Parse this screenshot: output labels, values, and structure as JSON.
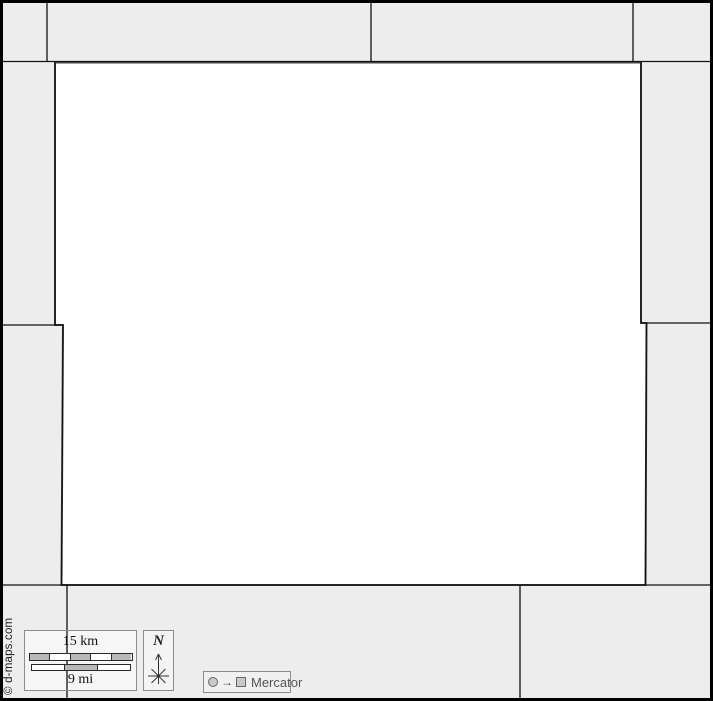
{
  "map": {
    "copyright": "© d-maps.com",
    "scale_bar": {
      "km_label": "15 km",
      "mi_label": "9 mi"
    },
    "north": {
      "label": "N"
    },
    "projection": {
      "label": "Mercator",
      "arrow_glyph": "→"
    }
  },
  "colors": {
    "background": "#ededed",
    "main_region_fill": "#ffffff",
    "boundary_line": "#111111",
    "main_region_outline": "#4a4a4a",
    "frame_border": "#000000",
    "scale_segment_gray": "#b8b8b8",
    "box_border": "#8c8c8c",
    "projection_text": "#555555"
  }
}
